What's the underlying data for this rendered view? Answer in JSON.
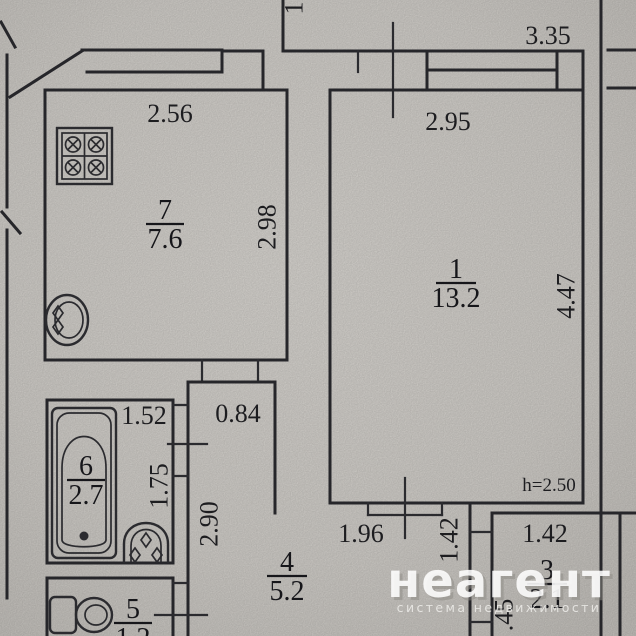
{
  "rooms": {
    "kitchen": {
      "number": "7",
      "area": "7.6"
    },
    "living": {
      "number": "1",
      "area": "13.2"
    },
    "bath": {
      "number": "6",
      "area": "2.7"
    },
    "hall": {
      "number": "4",
      "area": "5.2"
    },
    "wc": {
      "number": "5",
      "area": "1.2"
    },
    "storage": {
      "number": "3",
      "area": "2.1"
    }
  },
  "dims": {
    "kitchen_width": "2.56",
    "kitchen_depth": "2.98",
    "living_width": "2.95",
    "living_depth": "4.47",
    "outer_width": "3.35",
    "vestibule_width": "0.84",
    "bath_width": "1.52",
    "bath_depth": "1.75",
    "hall_depth": "2.90",
    "hall_width": "1.96",
    "door_width": "1.42",
    "storage_width": "1.42",
    "wall_segment": ".45",
    "ceiling_height": "h=2.50",
    "top_cut_label": "1"
  },
  "watermark": {
    "brand": "неагент",
    "tagline": "система недвижимости"
  },
  "colors": {
    "paper": "#d7d4cf",
    "ink": "#26262a",
    "watermark": "#ffffff"
  }
}
